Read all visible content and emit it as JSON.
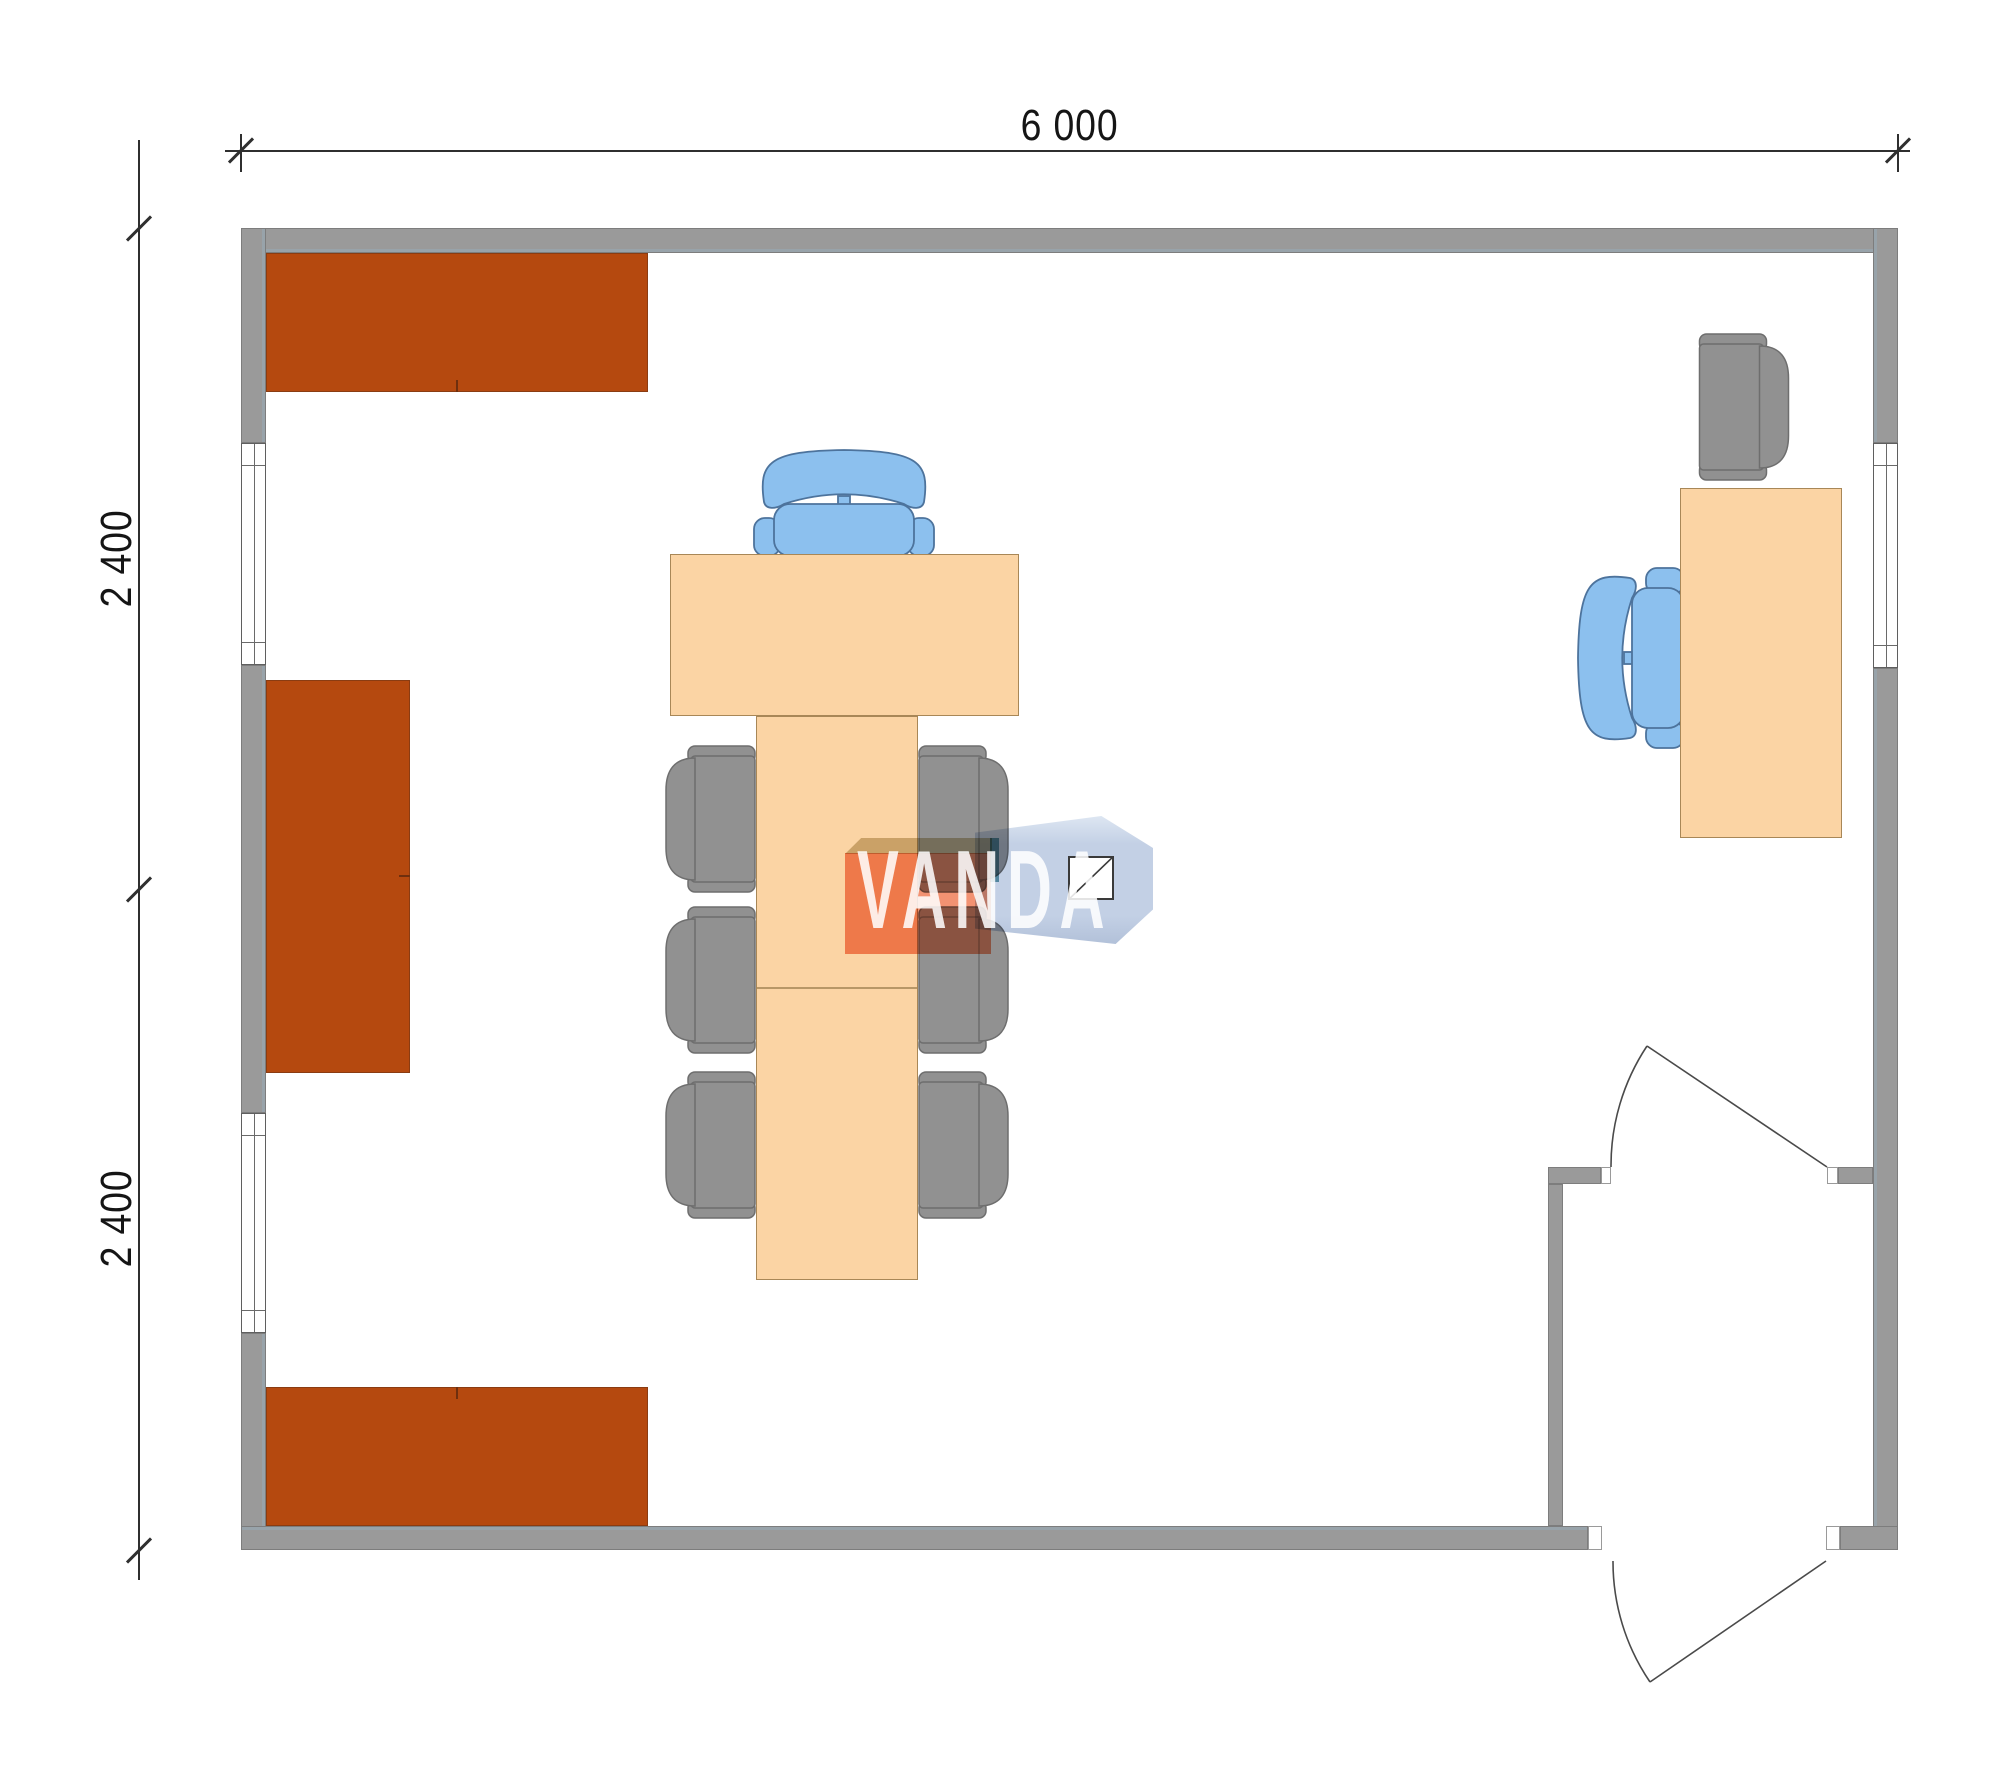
{
  "page": {
    "title": "Office module floor plan"
  },
  "dimensions": {
    "top_width": "6 000",
    "left_upper_height": "2 400",
    "left_lower_height": "2 400"
  },
  "watermark": {
    "brand": "VANDA"
  },
  "room": {
    "width_mm": 6000,
    "depth_mm": 4800,
    "modules": 2
  },
  "furniture_counts": {
    "wall_cabinets": 3,
    "windows": 3,
    "doors": 2,
    "meeting_chairs_gray": 6,
    "visitor_armchair_gray": 1,
    "office_chairs_blue": 2,
    "meeting_table_sections": 3,
    "desk": 1
  },
  "colors": {
    "wall": "#9a9a9a",
    "wall_border": "#7d7d7d",
    "cabinet": "#b5490f",
    "cabinet_edge": "#8a3c12",
    "table": "#fbd4a4",
    "table_border": "#a88757",
    "chair_gray": "#919191",
    "chair_gray_border": "#6e6e6e",
    "chair_blue": "#8cc0ee",
    "chair_blue_border": "#4d739c",
    "dim": "#2f2f2f",
    "logo_salmon": "#f29272",
    "logo_blue": "#c3d0e5",
    "logo_tan": "#cec2a0",
    "logo_teal": "#6ba3b0"
  }
}
